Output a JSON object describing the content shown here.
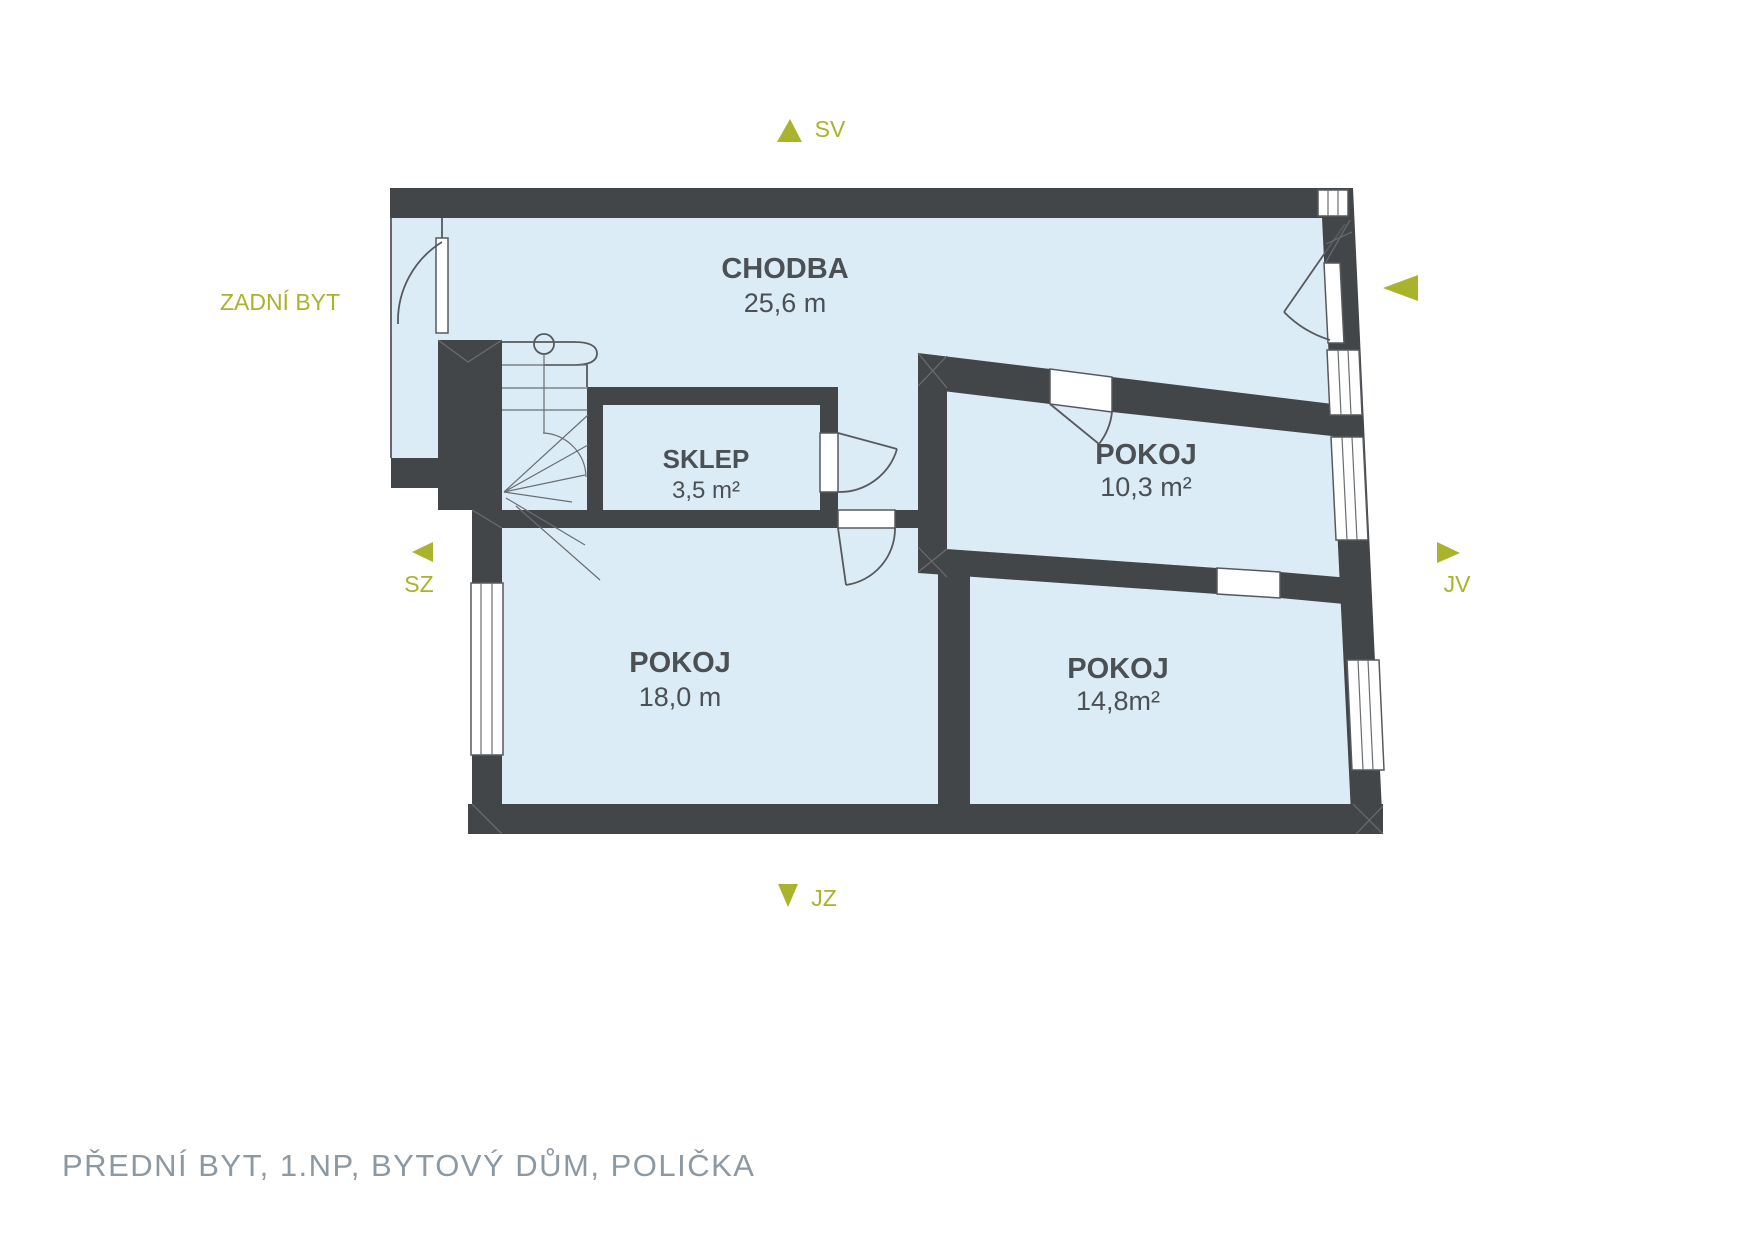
{
  "caption": "PŘEDNÍ BYT, 1.NP, BYTOVÝ DŮM, POLIČKA",
  "neighbor_label": "ZADNÍ BYT",
  "compass": {
    "north_east": "SV",
    "south_west": "JZ",
    "north_west": "SZ",
    "south_east": "JV"
  },
  "rooms": [
    {
      "name": "CHODBA",
      "area": "25,6 m"
    },
    {
      "name": "SKLEP",
      "area": "3,5 m²"
    },
    {
      "name": "POKOJ",
      "area": "10,3 m²"
    },
    {
      "name": "POKOJ",
      "area": "18,0 m"
    },
    {
      "name": "POKOJ",
      "area": "14,8m²"
    }
  ],
  "colors": {
    "room_fill": "#dcecf6",
    "wall": "#424649",
    "accent": "#a9b32c",
    "room_text": "#4b5055",
    "caption_text": "#8c99a3"
  }
}
